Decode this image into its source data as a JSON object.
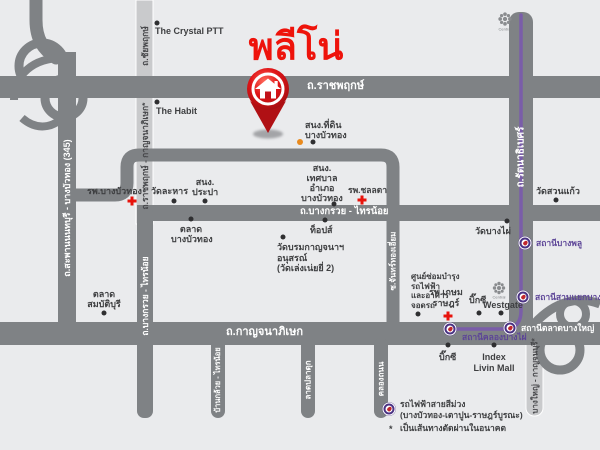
{
  "title": "พลีโน่",
  "colors": {
    "background": "#eaebed",
    "road": "#7f8285",
    "road_future": "#c9cacc",
    "title_red": "#ee130b",
    "purple_line": "#7a5da9",
    "station_purple": "#4a3284",
    "station_label_purple": "#5c4497",
    "poi_dot": "#2f2f31",
    "project_dot_orange": "#e98a1e",
    "hospital_cross_red": "#e8130c"
  },
  "road_labels": {
    "ratchaphruek": "ถ.ราชพฤกษ์",
    "bangkruai_sainoi_h": "ถ.บางกรวย - ไทรน้อย",
    "kanchanaphisek": "ถ.กาญจนาภิเษก",
    "sapan_nonthaburi_345": "ถ.สะพานนนทบุรี - บางบัวทอง (345)",
    "chaiyaphruek": "ถ.ชัยพฤกษ์",
    "ratchaphruek_kanchanaphisek_future": "ถ.ราชพฤกษ์ - กาญจนาภิเษก*",
    "bangkruai_sainoi_v": "ถ.บางกรวย - ไทรน้อย",
    "chan_thong_iam": "ซ.จันทร์ทองเอี่ยม",
    "rattanathibet": "ถ.รัตนาธิเบศร์",
    "ban_kluai_sainoi": "บ้านกล้วย - ไทรน้อย",
    "lat_pla_duk": "ลาดปลาดุก",
    "khlong_thanon": "คลองถนน",
    "bang_yai_kanchanaburi_future": "บางใหญ่ - กาญจนบุรี*"
  },
  "pois": {
    "crystal_ptt": {
      "lines": [
        "The Crystal PTT"
      ]
    },
    "habit": {
      "lines": [
        "The Habit"
      ]
    },
    "land_office": {
      "lines": [
        "สนง.ที่ดิน",
        "บางบัวทอง"
      ]
    },
    "municipal_office": {
      "lines": [
        "สนง.",
        "เทศบาล",
        "อำเภอ",
        "บางบัวทอง"
      ]
    },
    "chonlada_hospital": {
      "lines": [
        "รพ.ชลลดา"
      ]
    },
    "bangbuathong_hospital": {
      "lines": [
        "รพ.บางบัวทอง"
      ]
    },
    "wat_lahan": {
      "lines": [
        "วัดละหาร"
      ]
    },
    "waterworks_office": {
      "lines": [
        "สนง.",
        "ประปา"
      ]
    },
    "talat_bangbuathong": {
      "lines": [
        "ตลาด",
        "บางบัวทอง"
      ]
    },
    "talat_sombatburi": {
      "lines": [
        "ตลาด",
        "สมบัติบุรี"
      ]
    },
    "wat_borommakanchana": {
      "lines": [
        "วัดบรมกาญจนาฯ",
        "อนุสรณ์",
        "(วัดเล่งเน่ยยี่ 2)"
      ]
    },
    "tops": {
      "lines": [
        "ท็อปส์"
      ]
    },
    "wat_bangphai": {
      "lines": [
        "วัดบางไผ่"
      ]
    },
    "mrt_depot": {
      "lines": [
        "ศูนย์ซ่อมบำรุง",
        "รถไฟฟ้า",
        "และอาคาร",
        "จอดรถ"
      ]
    },
    "kasemrad_hospital": {
      "lines": [
        "รพ.เกษม",
        "ราษฎร์"
      ]
    },
    "bigc_westgate": {
      "lines": [
        "บิ๊กซี"
      ]
    },
    "westgate_mall": {
      "lines": [
        "Westgate"
      ]
    },
    "wat_suan_kaew": {
      "lines": [
        "วัดสวนแก้ว"
      ]
    },
    "bigc_bangyai": {
      "lines": [
        "บิ๊กซี"
      ]
    },
    "index_livin_mall": {
      "lines": [
        "Index",
        "Livin Mall"
      ]
    }
  },
  "stations": {
    "bangphlu": "สถานีบางพลู",
    "samyaek_bangyai": "สถานีสามแยกบางใหญ่",
    "talat_bangyai": "สถานีตลาดบางใหญ่",
    "khlong_bangphai": "สถานีคลองบางไผ่"
  },
  "legend": {
    "line1": "รถไฟฟ้าสายสีม่วง",
    "line2": "(บางบัวทอง-เตาปูน-ราษฎร์บูรณะ)",
    "asterisk": "*",
    "note": "เป็นเส้นทางตัดผ่านในอนาคต"
  },
  "logos": {
    "central_caption": "Central"
  }
}
